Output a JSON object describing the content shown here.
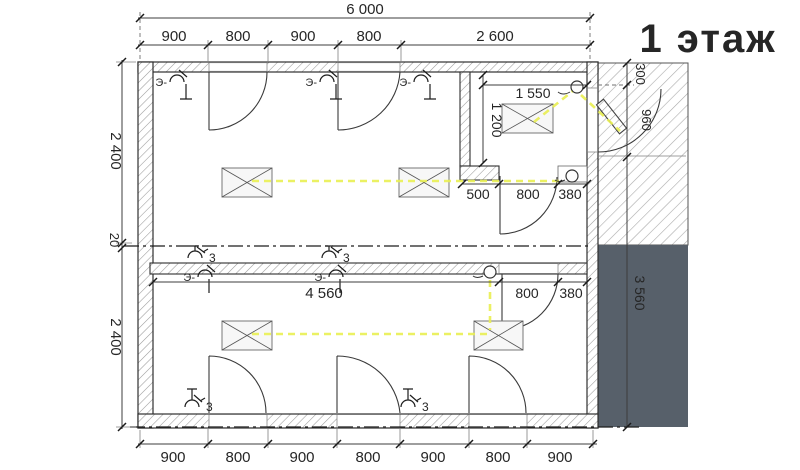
{
  "drawing": {
    "title": "1 этаж"
  },
  "dims": {
    "overall_top": "6 000",
    "top": [
      "900",
      "800",
      "900",
      "800",
      "2 600"
    ],
    "bottom": [
      "900",
      "800",
      "900",
      "800",
      "900",
      "800",
      "900"
    ],
    "left_upper": "2 400",
    "left_gap": "20",
    "left_lower": "2 400",
    "tambour_w": "1 550",
    "tambour_d": "1 200",
    "entry_step": [
      "500",
      "800",
      "380"
    ],
    "hall": [
      "4 560",
      "800",
      "380"
    ],
    "right_offset": "300",
    "right_door": "960",
    "right_side": "3 560"
  },
  "electrical": {
    "switch_label_prefix": "Э-",
    "switch_circuit": "3"
  },
  "colors": {
    "wire_yellow": "#e9ef52",
    "slab_gray": "#57606a",
    "title_red": "#e51414"
  }
}
